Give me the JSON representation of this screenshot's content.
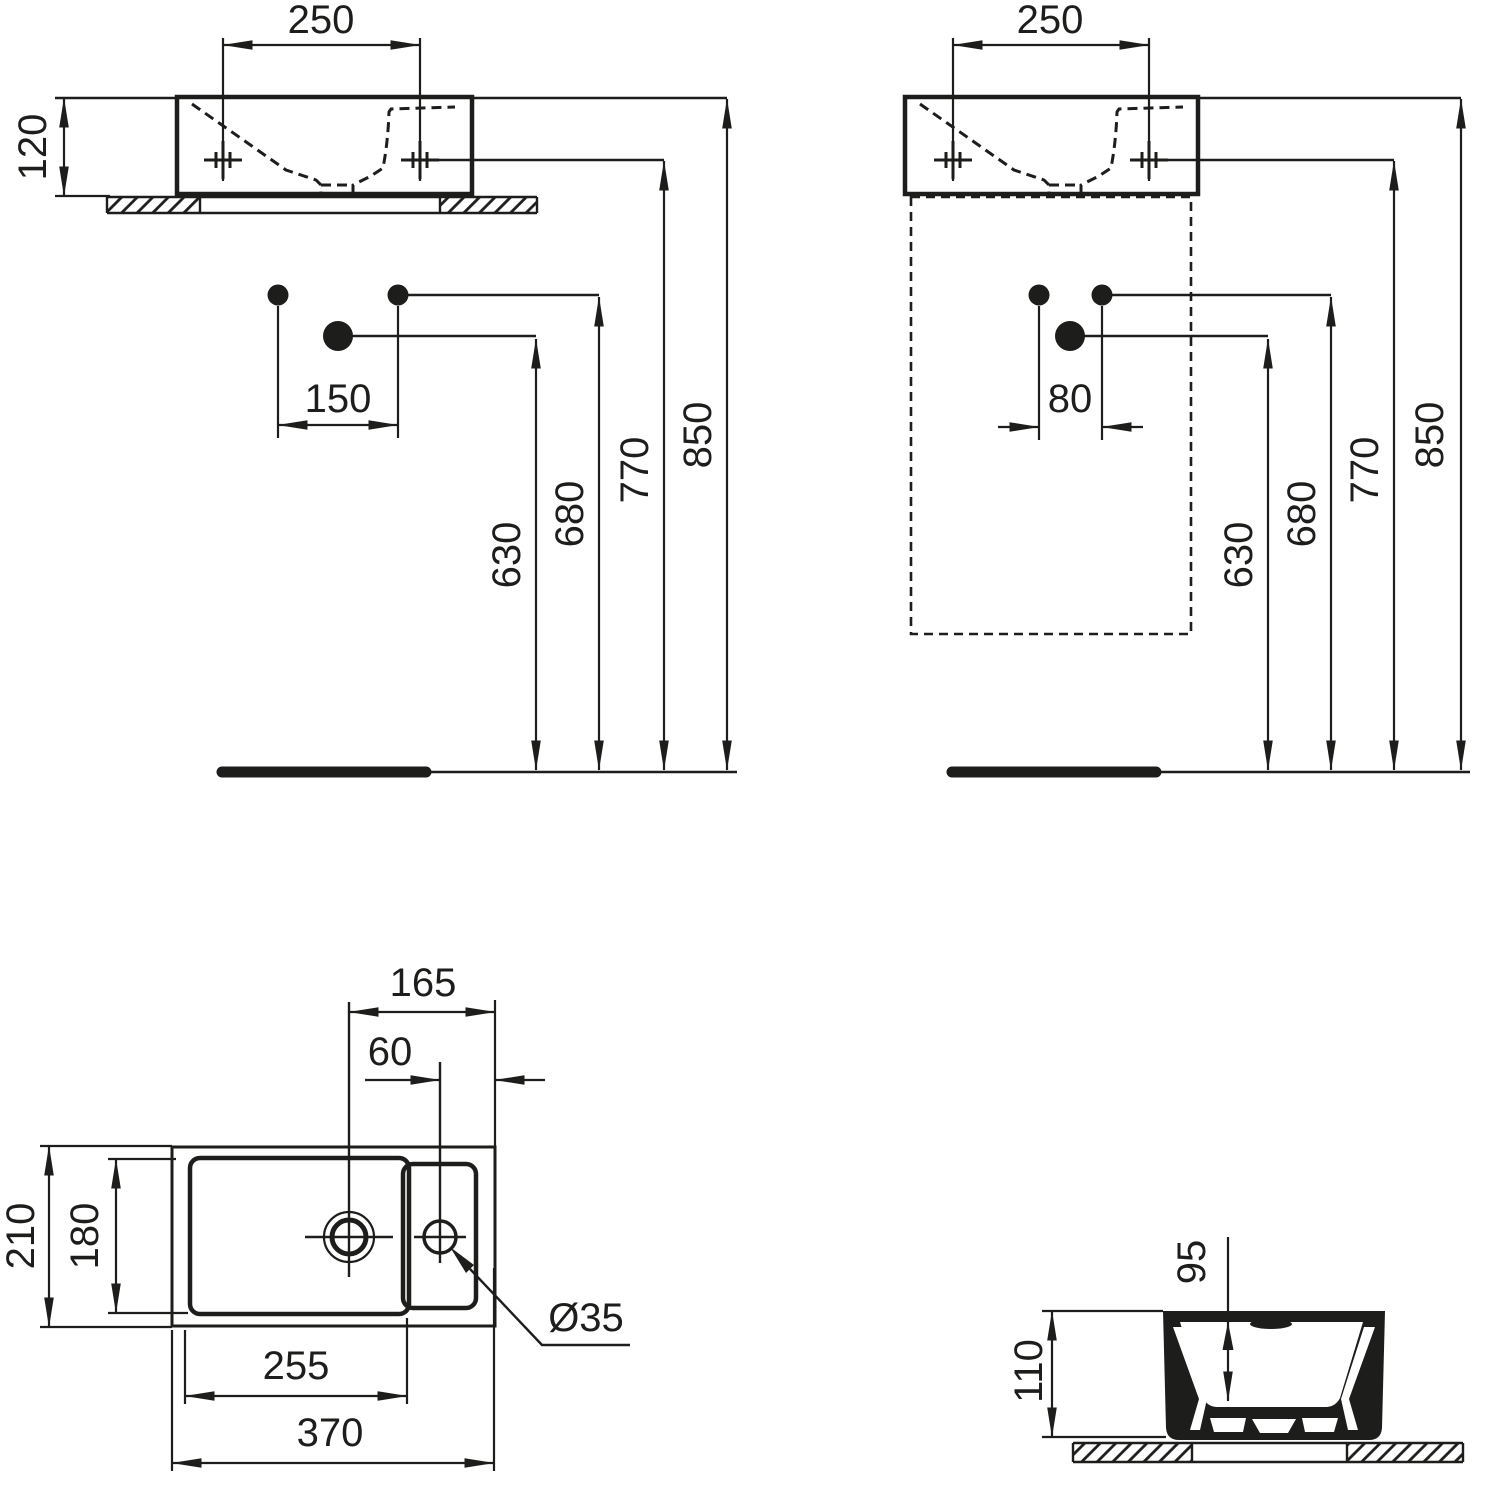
{
  "drawing": {
    "type": "washbasin installation dimension drawing",
    "line_color": "#1d1d1b",
    "background_color": "#ffffff",
    "views": {
      "front_wall": {
        "dims": {
          "hole_spacing": "250",
          "basin_height": "120",
          "tap_distance": "150",
          "drain_height": "630",
          "supply_height": "680",
          "fixing_height": "770",
          "rim_height": "850"
        }
      },
      "front_furniture": {
        "dims": {
          "hole_spacing": "250",
          "tap_distance": "80",
          "drain_height": "630",
          "supply_height": "680",
          "fixing_height": "770",
          "rim_height": "850"
        }
      },
      "plan": {
        "dims": {
          "drain_offset": "165",
          "tap_offset": "60",
          "overall_depth": "210",
          "bowl_depth": "180",
          "bowl_width": "255",
          "overall_width": "370",
          "tap_hole_diameter": "Ø35"
        }
      },
      "side": {
        "dims": {
          "bowl_depth": "95",
          "overall_height": "110"
        }
      }
    }
  }
}
